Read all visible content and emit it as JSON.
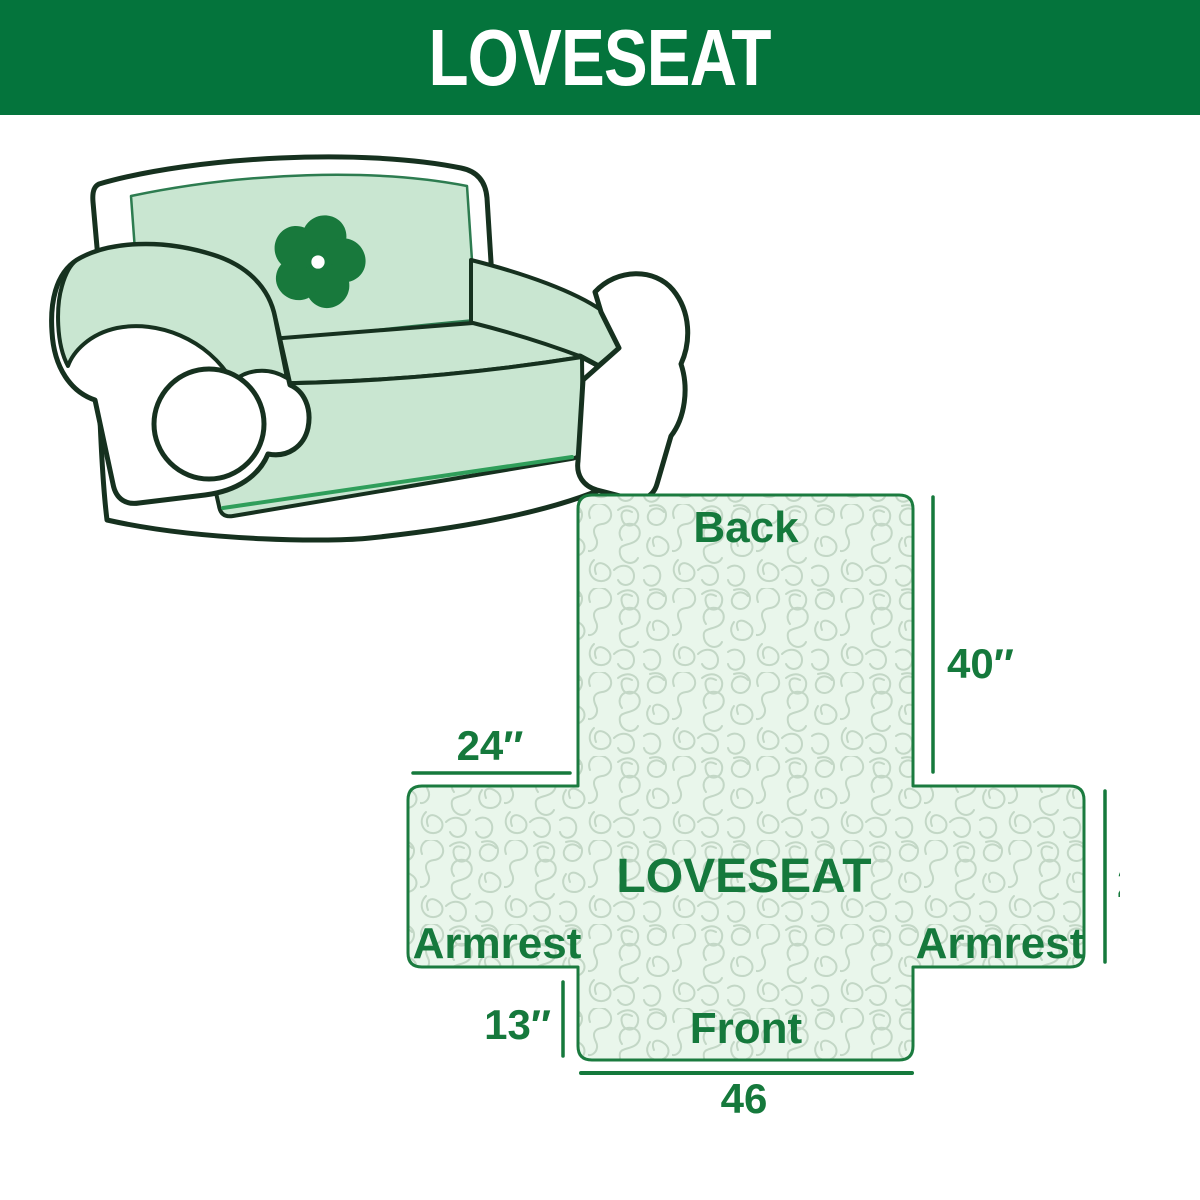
{
  "header": {
    "title": "LOVESEAT",
    "bg_color": "#04743C",
    "text_color": "#FFFFFF"
  },
  "illustration": {
    "subject": "loveseat sofa line drawing with quilted cover",
    "logo": "pinwheel-flower",
    "cover_color": "#C9E6D1",
    "outline_color": "#16311F",
    "logo_color": "#18793C"
  },
  "diagram": {
    "center_label": "LOVESEAT",
    "labels": {
      "back": "Back",
      "front": "Front",
      "armrest_left": "Armrest",
      "armrest_right": "Armrest"
    },
    "dimensions": {
      "back_height": "40″",
      "armrest_width": "24″",
      "side_height": "23″",
      "front_drop": "13″",
      "front_width": "46"
    },
    "colors": {
      "outline": "#1B7B3F",
      "fill": "#E9F6EB",
      "pattern_line": "#C3D7C6",
      "text": "#15793C"
    }
  }
}
